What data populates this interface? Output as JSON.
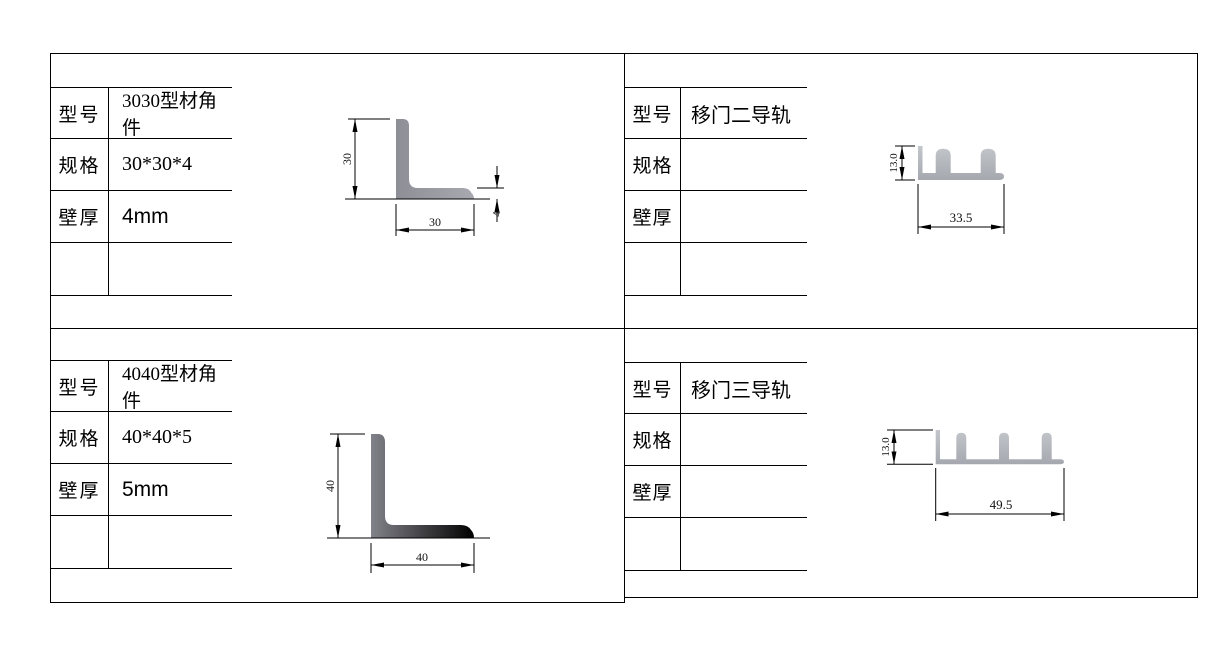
{
  "labels": {
    "model": "型号",
    "spec": "规格",
    "wall": "壁厚"
  },
  "panels": {
    "tl": {
      "model": "3030型材角件",
      "spec": "30*30*4",
      "wall": "4mm",
      "dims": {
        "height": "30",
        "width": "30",
        "thickness": "4"
      }
    },
    "tr": {
      "model": "移门二导轨",
      "spec": "",
      "wall": "",
      "dims": {
        "height": "13.0",
        "width": "33.5"
      }
    },
    "bl": {
      "model": "4040型材角件",
      "spec": "40*40*5",
      "wall": "5mm",
      "dims": {
        "height": "40",
        "width": "40"
      }
    },
    "br": {
      "model": "移门三导轨",
      "spec": "",
      "wall": "",
      "dims": {
        "height": "13.0",
        "width": "49.5"
      }
    }
  },
  "colors": {
    "line": "#000000",
    "profile_gray": "#9a9aa2",
    "track_gray": "#b3b6bc"
  }
}
